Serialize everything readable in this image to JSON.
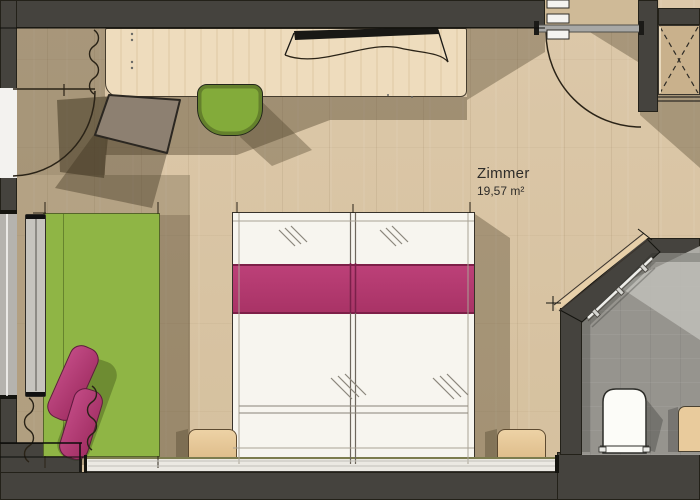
{
  "room": {
    "label": "Zimmer",
    "area": "19,57 m²"
  },
  "colors": {
    "floor_wood": "#d8c4a4",
    "wall_dark": "#45433e",
    "bed_runner_pink": "#b43a70",
    "daybed_green": "#8fb545",
    "stool_green": "#83ab3a",
    "desk_wood": "#ecdabb",
    "bathroom_tile_grey": "#96948e",
    "bed_linen_white": "#f7f5ef",
    "cushion_magenta": "#b5417b",
    "shadow_olive": "rgba(72,60,38,0.40)"
  },
  "furniture_icons": [
    "double-bed",
    "bed-runner",
    "nightstand",
    "desk-sideboard",
    "tv",
    "office-chair",
    "stool",
    "daybed",
    "cushion",
    "wardrobe",
    "radiator",
    "toilet",
    "vanity",
    "shower-glass",
    "door-swing",
    "window",
    "insulation-squiggle"
  ]
}
